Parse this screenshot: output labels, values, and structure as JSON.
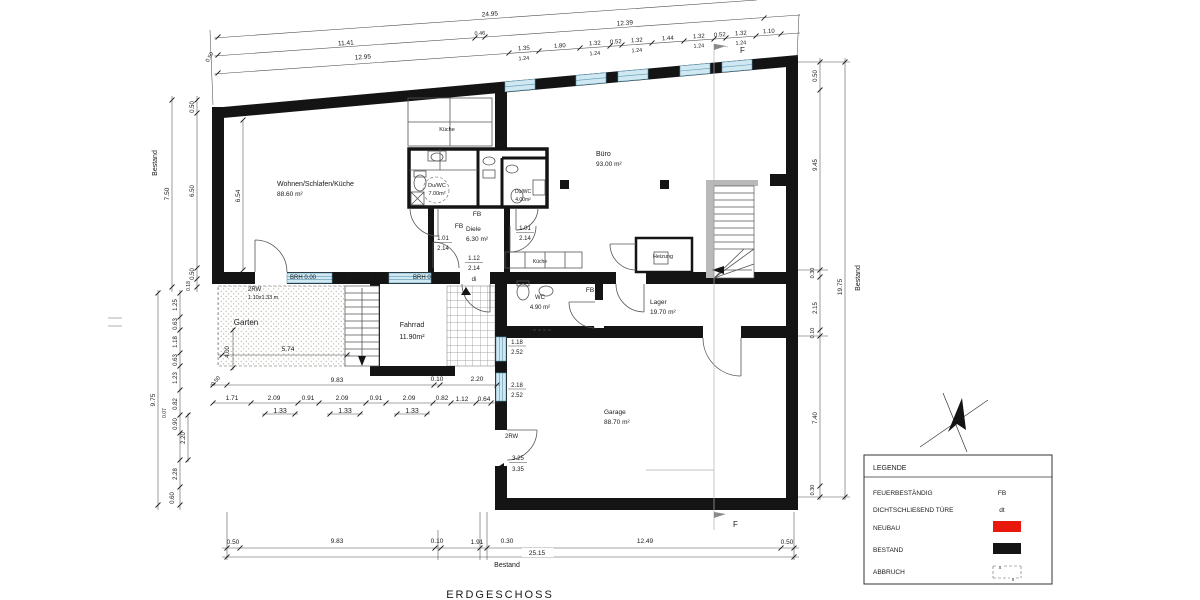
{
  "title": "ERDGESCHOSS",
  "section_marker": "F",
  "rooms": {
    "wohnen": {
      "name": "Wohnen/Schlafen/Küche",
      "area": "88.60 m²"
    },
    "buero": {
      "name": "Büro",
      "area": "93.00 m²"
    },
    "diele": {
      "name": "Diele",
      "area": "6.30 m²"
    },
    "duwc1": {
      "name": "Du/WC",
      "area": "7.00m²"
    },
    "duwc2": {
      "name": "Du/WC",
      "area": "4.00m²"
    },
    "wc": {
      "name": "WC",
      "area": "4.90 m²"
    },
    "lager": {
      "name": "Lager",
      "area": "19.70 m²"
    },
    "garage": {
      "name": "Garage",
      "area": "88.70 m²"
    },
    "fahrrad": {
      "name": "Fahrrad",
      "area": "11.90m²"
    },
    "garten": {
      "name": "Garten"
    },
    "heizung": {
      "name": "Heizung"
    },
    "kueche_top": "Küche",
    "kueche_small": "Küche"
  },
  "labels": {
    "brh": [
      "BRH 0.00",
      "BRH 0.90",
      "BRH 0.90"
    ],
    "fb": "FB",
    "rw1_line1": "2RW",
    "rw1_line2": "1.10x1.33 m",
    "rw2": "2RW",
    "bestand": "Bestand",
    "abbruch_x": "x"
  },
  "dims": {
    "top_a": "24.95",
    "top_b": [
      "11.41",
      "0.46",
      "12.39"
    ],
    "top_c": "12.95",
    "top_seg": [
      "1.35",
      "1.80",
      "1.32",
      "0.52",
      "1.32",
      "1.44",
      "1.32",
      "0.52",
      "1.32",
      "1.10"
    ],
    "top_sub": [
      "1.24",
      "1.24",
      "1.24",
      "1.24",
      "1.24"
    ],
    "top_left_end": "0.50",
    "left_upper": [
      "0.50",
      "6.50",
      "0.50",
      "0.18"
    ],
    "left_upper_total": "7.50",
    "left_lower": [
      "1.25",
      "0.63",
      "1.18",
      "0.63",
      "1.23",
      "0.82",
      "0.07",
      "0.90",
      "2.20",
      "2.28",
      "0.60"
    ],
    "left_lower_total": "9.75",
    "right_seg": [
      "0.50",
      "9.45",
      "0.30",
      "2.15",
      "0.10",
      "7.40",
      "0.30"
    ],
    "right_total": "19.75",
    "mid": [
      "0.50",
      "9.83",
      "0.10",
      "2.20"
    ],
    "row2": [
      "1.71",
      "2.09",
      "0.91",
      "2.09",
      "0.91",
      "2.09",
      "0.82",
      "1.12",
      "0.64"
    ],
    "row3": [
      "1.33",
      "1.33",
      "1.33"
    ],
    "garten_w": "5.74",
    "garten_h": "4.00",
    "interior_left": "6.54",
    "bottom": [
      "0.50",
      "9.83",
      "0.10",
      "1.91",
      "0.30",
      "12.49",
      "0.50"
    ],
    "bottom_total": "25.15",
    "win1": [
      "1.18",
      "2.52"
    ],
    "win2": [
      "2.18",
      "2.52"
    ],
    "garage_door": [
      "3.25",
      "3.35"
    ],
    "door1": [
      "1.01",
      "2.14"
    ],
    "door2": [
      "1.01",
      "2.14"
    ],
    "door3": [
      "1.12",
      "2.14",
      "di"
    ]
  },
  "legend": {
    "header": "LEGENDE",
    "rows": [
      "FEUERBESTÄNDIG",
      "DICHTSCHLIEßEND TÜRE",
      "NEUBAU",
      "BESTAND",
      "ABBRUCH"
    ],
    "fb": "FB",
    "dt": "dt"
  },
  "colors": {
    "neubau": "#e8190c",
    "bestand": "#141414",
    "window": "#cfe8f2"
  }
}
